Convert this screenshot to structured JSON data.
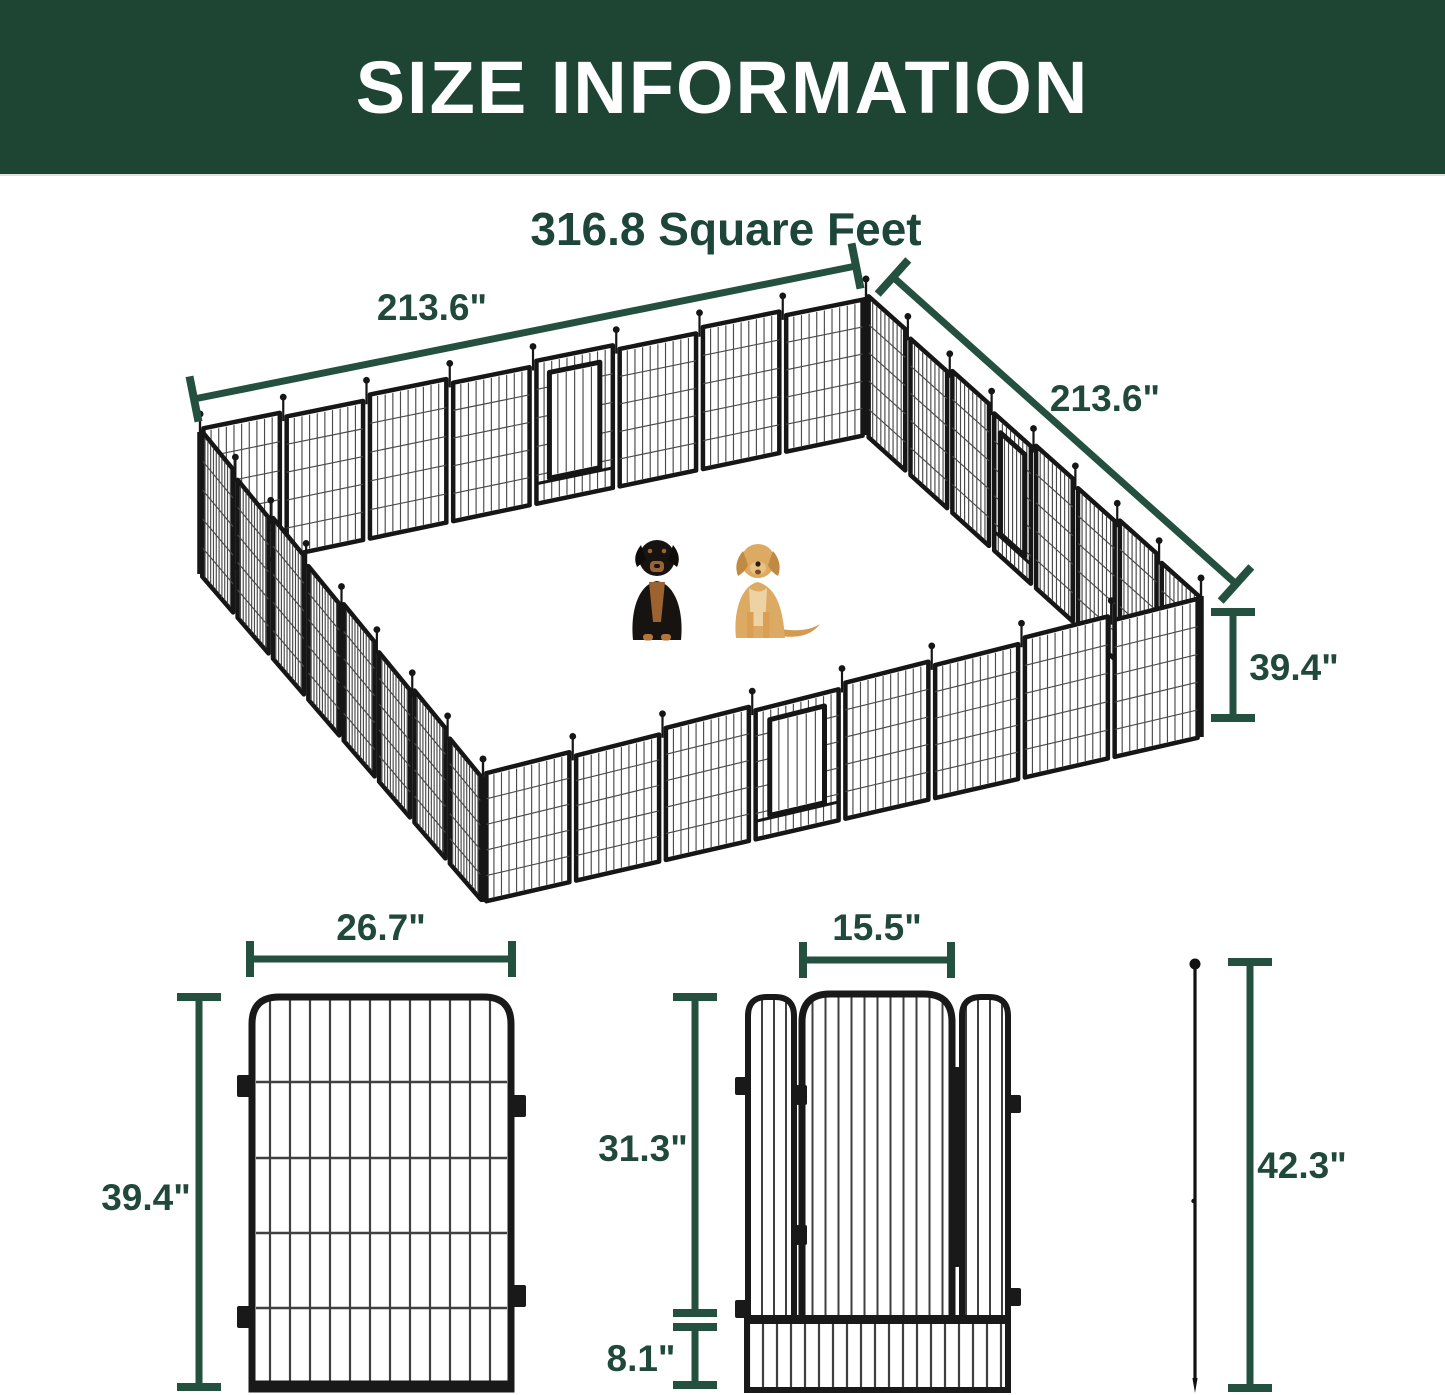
{
  "header": {
    "title": "SIZE INFORMATION"
  },
  "overview": {
    "area_title": "316.8 Square Feet",
    "back_left_dimension": "213.6\"",
    "back_right_dimension": "213.6\"",
    "panel_height_dimension": "39.4\"",
    "figures": {
      "left_dog": "rottweiler",
      "right_dog": "golden-retriever"
    }
  },
  "panel_detail": {
    "width_dimension": "26.7\"",
    "height_dimension": "39.4\""
  },
  "gate_detail": {
    "door_width_dimension": "15.5\"",
    "door_height_dimension": "31.3\"",
    "bottom_height_dimension": "8.1\""
  },
  "stake_detail": {
    "length_dimension": "42.3\""
  },
  "colors": {
    "banner_background": "#1e4433",
    "accent_green": "#24503f",
    "fence_black": "#161616",
    "wire_gray": "#4a4a4a"
  }
}
